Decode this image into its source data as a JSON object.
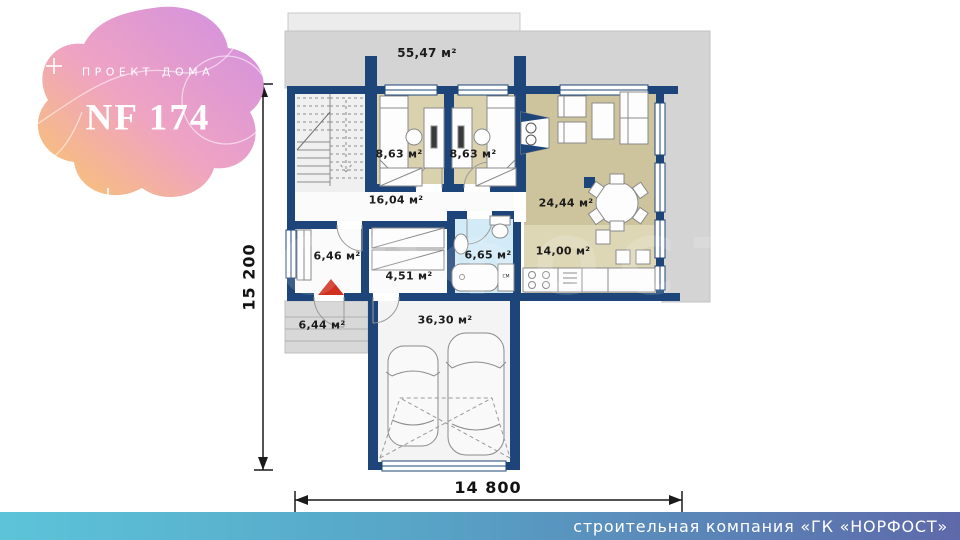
{
  "logo": {
    "subtitle": "ПРОЕКТ ДОМА",
    "title": "NF 174"
  },
  "dimensions": {
    "height_label": "15 200",
    "width_label": "14 800"
  },
  "rooms": [
    {
      "id": "terrace",
      "area": "55,47 м²"
    },
    {
      "id": "bedroom-1",
      "area": "8,63 м²"
    },
    {
      "id": "bedroom-2",
      "area": "8,63 м²"
    },
    {
      "id": "hallway",
      "area": "16,04 м²"
    },
    {
      "id": "living-room",
      "area": "24,44 м²"
    },
    {
      "id": "entry",
      "area": "6,46 м²"
    },
    {
      "id": "corridor",
      "area": "4,51 м²"
    },
    {
      "id": "bathroom",
      "area": "6,65 м²"
    },
    {
      "id": "kitchen",
      "area": "14,00 м²"
    },
    {
      "id": "porch",
      "area": "6,44 м²"
    },
    {
      "id": "garage",
      "area": "36,30 м²"
    }
  ],
  "labels": {
    "washing_machine": "СМ"
  },
  "watermark": "НОРФОСТ",
  "footer": {
    "company": "строительная компания «ГК «НОРФОСТ»"
  },
  "colors": {
    "wall": "#1d4579",
    "bedroom_floor": "#dad2ae",
    "living_floor": "#cdc39c",
    "kitchen_floor": "#ded7b6",
    "bathroom_floor": "#d3ebf7",
    "terrace_gray": "#d4d4d4",
    "entrance_red": "#d03020",
    "footer_left": "#5cc4d9",
    "footer_right": "#5e69aa"
  }
}
